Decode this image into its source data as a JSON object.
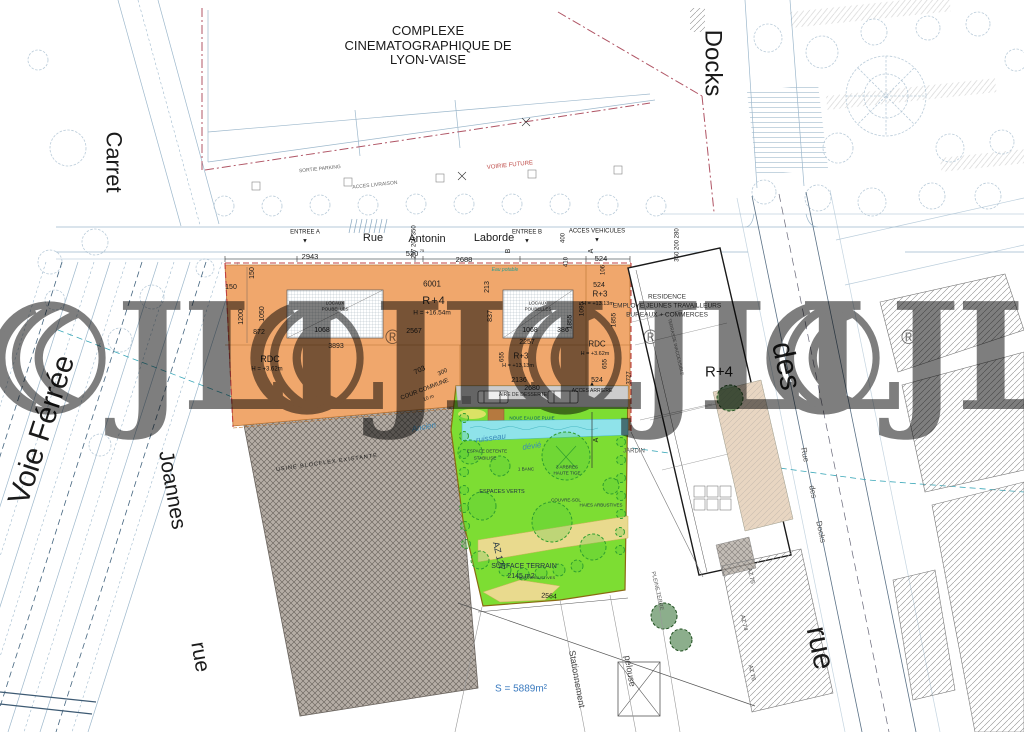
{
  "title": {
    "l1": "COMPLEXE",
    "l2": "CINEMATOGRAPHIQUE DE",
    "l3": "LYON-VAISE"
  },
  "streets": {
    "carret": "Carret",
    "docks_top": "Docks",
    "voie_ferree": "Voie Férrée",
    "joannes": "Joannes",
    "rue_left": "rue",
    "rue_w1": "Rue",
    "rue_w2": "Antonin",
    "rue_w3": "Laborde",
    "des_right": "des",
    "rue_right": "rue",
    "rds1": "Rue",
    "rds2": "des",
    "rds3": "Docks"
  },
  "access": {
    "entree_a": "ENTREE A",
    "entree_b": "ENTREE B",
    "acces_vehicules": "ACCES VEHICULES",
    "acces_arriere": "ACCES ARRIERE",
    "sortie_parking": "SORTIE PARKING",
    "acces_livraison": "ACCES LIVRAISON",
    "voirie_future": "VOIRIE FUTURE",
    "eau_potable": "Eau potable"
  },
  "marks": {
    "down": "▼",
    "up": "▲"
  },
  "building_orange": {
    "r4": "R+4",
    "r4_h": "H = +16.54m",
    "r3": "R+3",
    "r3_h": "H = +13.13m",
    "r3b": "R+3",
    "r3b_h": "H = +13,13m",
    "rdc": "RDC",
    "rdc_h": "H = +3.62m",
    "rdc_r": "RDC",
    "rdc_r_h": "H = +3.62m",
    "locaux_l1": "LOCAUX",
    "locaux_l2": "POUBELLES",
    "cour_commune": "COUR COMMUNE",
    "cour_10m": "10 m"
  },
  "residence": {
    "l1": "RESIDENCE",
    "l2": "EMPLOYE JEUNES TRAVAILLEURS",
    "l3": "BUREAUX + COMMERCES",
    "r4": "R+4",
    "jardin": "JARDIN",
    "terrasse": "TERRASSE INACCESSIBLE"
  },
  "factory": {
    "label": "USINE BLOCFLEX EXISTANTE"
  },
  "green": {
    "aire": "AIRE DE DESSERTE",
    "noue": "NOUE EAU DE PLUIE",
    "ancien": "Ancien",
    "ruisseau": "ruisseau",
    "devie": "dévié",
    "espace_detente": "ESPACE DETENTE",
    "stabilise": "STABILISE",
    "banc": "1 BANC",
    "arbres1": "3 ARBRES",
    "arbres2": "HAUTE TIGE",
    "espaces_verts": "ESPACES VERTS",
    "couvre_sol": "COUVRE-SOL",
    "haies": "HAIES ARBUSTIVES",
    "haies2": "HAIES ARBUSTIVES",
    "surface1": "SURFACE TERRAIN",
    "surface2": "2145 m2",
    "az127": "AZ 127",
    "section_a": "A"
  },
  "misc": {
    "surface_total": "S = 5889m²",
    "stationnement": "Stationnement",
    "pelouse": "pelouse",
    "pleine_terre": "PLEINE TERRE",
    "az75": "AZ 75",
    "az74": "AZ 74",
    "az76": "AZ 76"
  },
  "dims": {
    "k2943": "2943",
    "k520": "520",
    "k520s": "75",
    "k2688": "2688",
    "k524a": "524",
    "r297": "297 200 350",
    "r400": "400",
    "r410": "410",
    "r350": "350 200 280",
    "mA": "A",
    "mB": "B",
    "k106": "106",
    "k6001": "6001",
    "k150a": "150",
    "k150b": "150",
    "k1200": "1200",
    "k1050": "1050",
    "k872": "872",
    "k1068a": "1068",
    "k2567": "2567",
    "k3893": "3893",
    "k213": "213",
    "k837": "837",
    "k1068b": "1068",
    "k386": "386",
    "k1855a": "1855",
    "k1095": "1095",
    "k1855b": "1855",
    "k3727": "3727",
    "k524b": "524",
    "k2257": "2257",
    "k655a": "655",
    "k655b": "655",
    "k2136": "2136",
    "k2680": "2680",
    "k524c": "524",
    "k703": "703",
    "k300": "300",
    "k2564": "2564"
  },
  "watermark": {
    "text": "JLL",
    "reg": "®"
  },
  "colors": {
    "orange": "#F0A76C",
    "green": "#7DDD33",
    "cyan": "#8FE3EA",
    "beige": "#E8D6C2",
    "watermark": "#7E7E7E",
    "blue_text": "#3A7ABF",
    "red_line": "#C04040"
  }
}
